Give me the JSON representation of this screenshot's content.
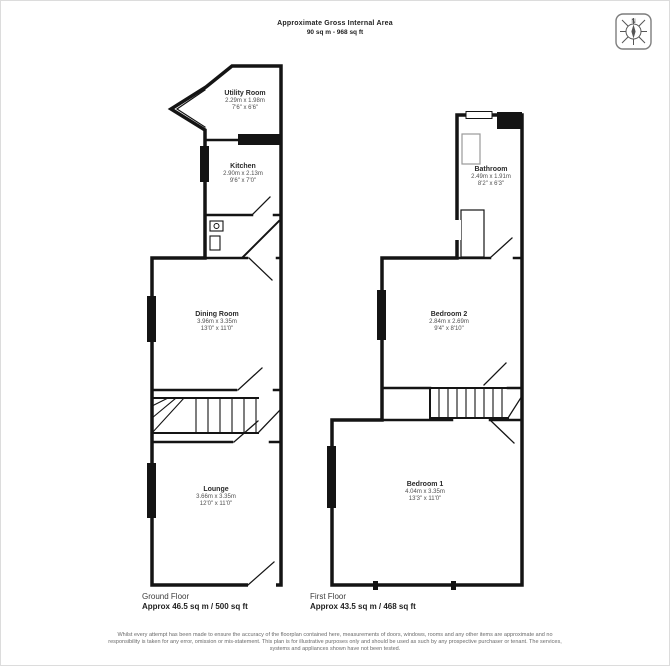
{
  "header": {
    "title_line1": "Approximate Gross Internal Area",
    "title_line2": "90 sq m - 968 sq ft"
  },
  "compass": {
    "north_label": "N"
  },
  "ground_floor": {
    "caption": "Ground Floor",
    "area": "Approx 46.5 sq m / 500 sq ft",
    "rooms": [
      {
        "name": "Utility Room",
        "dims_m": "2.29m x 1.98m",
        "dims_ft": "7'6\" x 6'6\""
      },
      {
        "name": "Kitchen",
        "dims_m": "2.90m x 2.13m",
        "dims_ft": "9'6\" x 7'0\""
      },
      {
        "name": "Dining Room",
        "dims_m": "3.96m x 3.35m",
        "dims_ft": "13'0\" x 11'0\""
      },
      {
        "name": "Lounge",
        "dims_m": "3.66m x 3.35m",
        "dims_ft": "12'0\" x 11'0\""
      }
    ]
  },
  "first_floor": {
    "caption": "First Floor",
    "area": "Approx 43.5 sq m / 468 sq ft",
    "rooms": [
      {
        "name": "Bathroom",
        "dims_m": "2.49m x 1.91m",
        "dims_ft": "8'2\" x 6'3\""
      },
      {
        "name": "Bedroom 2",
        "dims_m": "2.84m x 2.69m",
        "dims_ft": "9'4\" x 8'10\""
      },
      {
        "name": "Bedroom 1",
        "dims_m": "4.04m x 3.35m",
        "dims_ft": "13'3\" x 11'0\""
      }
    ]
  },
  "footer": {
    "disclaimer_line1": "Whilst every attempt has been made to ensure the accuracy of the floorplan contained here, measurements of doors, windows, rooms and any other items are approximate and no",
    "disclaimer_line2": "responsibility is taken for any error, omission or mis-statement. This plan is for illustrative purposes only and should be used as such by any prospective purchaser or tenant. The services,",
    "disclaimer_line3": "systems and appliances shown have not been tested."
  }
}
